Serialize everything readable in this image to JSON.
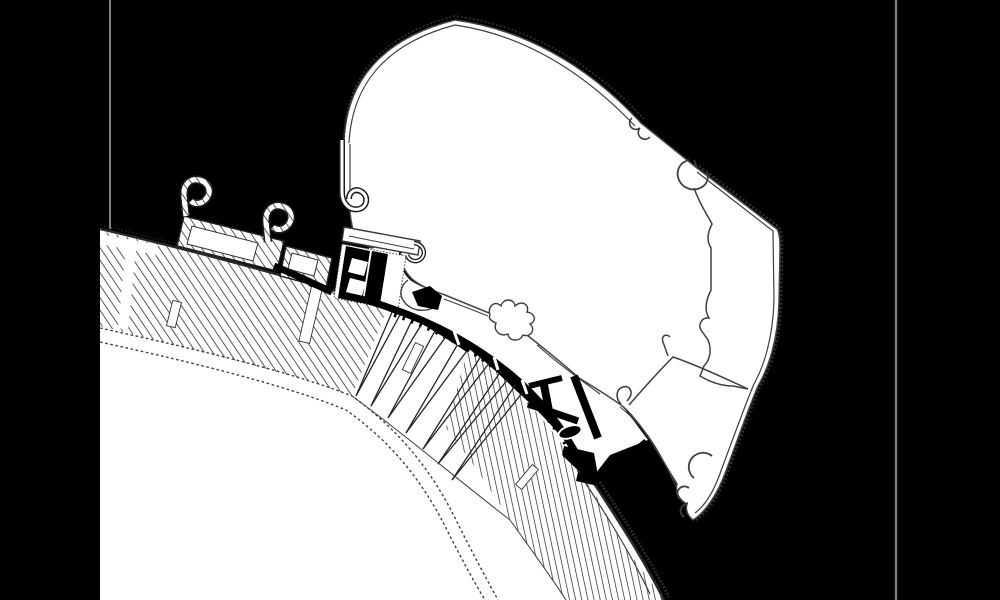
{
  "meta": {
    "title": "Awning roof adapter cross-section technical drawing",
    "width_px": 1000,
    "height_px": 600
  },
  "colors": {
    "background": "#000000",
    "paper": "#ffffff",
    "line": "#3f3f3f",
    "hatch": "#232323",
    "heavy_parts": "#000000",
    "frame_line": "#7f7f7f"
  },
  "drawing": {
    "type": "technical-cross-section",
    "elements": {
      "roof_panel": "curved vehicle roof sandwich with diagonal hatching, fan spokes at bend and dotted inner skin",
      "adapter_rail_left": "hatched mounting rail with two upward C-hooks",
      "adapter_rail_small": "short hatched rail segment",
      "mounting_bracket": "black C-bracket with white slots and keder rail",
      "awning_profile": "large white extruded awning bracket profile with clips, inner partitions and bottom tip",
      "adapter_curve": "heavy black curved adapter strip with teeth, T-post, strut, pad and L-foot",
      "screws": "4 white fastening screw slots in the roof hatch",
      "frame_lines": "gray vertical border hairlines at left (partial) and right (full height)"
    }
  }
}
